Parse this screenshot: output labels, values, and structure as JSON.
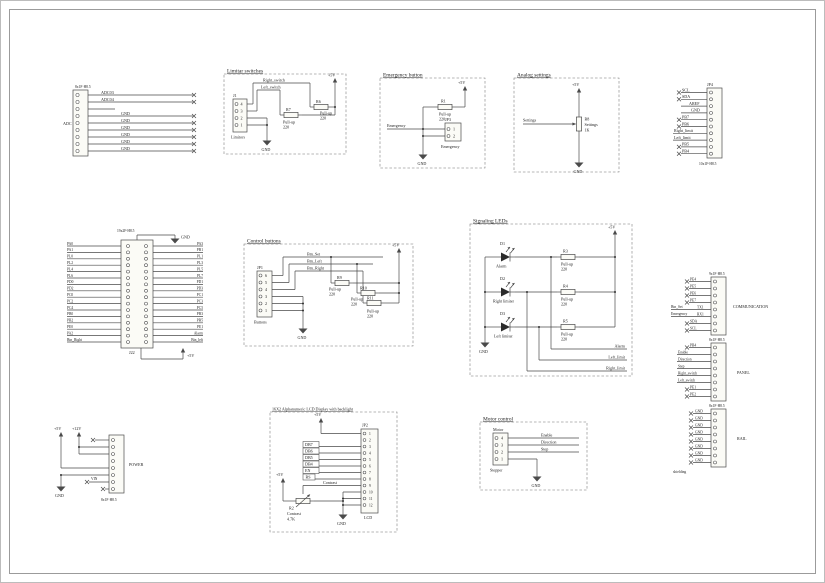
{
  "common": {
    "p5": "+5V",
    "p12": "+12V",
    "gnd": "GND",
    "pullup": "Pull-up",
    "r220": "220"
  },
  "adc": {
    "part": "8x1F-H8.5",
    "group": "ADC",
    "nets": [
      "ADC03",
      "ADC04",
      "",
      "GND",
      "GND",
      "GND",
      "GND",
      "GND",
      "GND"
    ]
  },
  "limits": {
    "title": "Limitar switches",
    "net_right": "Right_switch",
    "net_left": "Left_switch",
    "conn_ref": "J1",
    "conn_name": "Limitors",
    "pins": [
      "4",
      "3",
      "2",
      "1"
    ],
    "r7": "R7",
    "r6": "R6"
  },
  "emergency": {
    "title": "Emergency button",
    "r1": "R1",
    "net": "Emergency",
    "conn_ref": "JP3",
    "pins": [
      "1",
      "2"
    ],
    "conn_name": "Emergency"
  },
  "analog": {
    "title": "Analog settings",
    "net": "Settings",
    "pot_ref": "R8",
    "pot_l1": "Settings",
    "pot_l2": "1K"
  },
  "jp4": {
    "ref": "JP4",
    "part": "10x1F-H8.5",
    "nets": [
      "SCL",
      "SDA",
      "AREF",
      "GND",
      "PB7",
      "PB6",
      "Right_limit",
      "Left_limit",
      "PB5",
      "PB4"
    ]
  },
  "main": {
    "part": "19x2F-H8.5",
    "ref": "J22",
    "left": [
      "PA0",
      "PA1",
      "PL0",
      "PL2",
      "PL4",
      "PL6",
      "PD0",
      "PD2",
      "PC0",
      "PC2",
      "PC4",
      "PB0",
      "PB2",
      "PE0",
      "PA2",
      "Btn_Right"
    ],
    "right": [
      "PA3",
      "PB1",
      "PL1",
      "PL3",
      "PL5",
      "PL7",
      "PD1",
      "PD3",
      "PC1",
      "PC3",
      "PC5",
      "PB3",
      "PB5",
      "PE1",
      "Alarm",
      "Btn_left"
    ]
  },
  "buttons": {
    "title": "Control buttons",
    "nets": [
      "Btn_Set",
      "Btn_Left",
      "Btn_Right"
    ],
    "conn_ref": "JP1",
    "conn_name": "Buttons",
    "pins": [
      "6",
      "5",
      "4",
      "3",
      "2",
      "1"
    ],
    "r": [
      "R9",
      "R10",
      "R11"
    ]
  },
  "leds": {
    "title": "Signaling LEDs",
    "d": [
      {
        "ref": "D1",
        "name": "Alarm"
      },
      {
        "ref": "D2",
        "name": "Right limiter"
      },
      {
        "ref": "D3",
        "name": "Left limiter"
      }
    ],
    "r": [
      "R3",
      "R4",
      "R5"
    ],
    "out": [
      "Alarm",
      "Left_limit",
      "Right_limit"
    ]
  },
  "io": {
    "part1": "9x1F-H8.5",
    "nets1": [
      "PE4",
      "PE5",
      "PE6",
      "PE7",
      "TX1",
      "RX1",
      "SDA",
      "SCL"
    ],
    "ext1": "Btn_Set",
    "ext2": "Emergency",
    "group1": "COMMUNICATION",
    "part2": "8x1F-H8.5",
    "nets2": [
      "PB4",
      "Enable",
      "Direction",
      "Step",
      "Right_switch",
      "Left_switch",
      "PE1",
      "PE2"
    ],
    "group2": "PANEL",
    "part3": "8x1F-H8.5",
    "nets3": [
      "GND",
      "GND",
      "GND",
      "GND",
      "GND",
      "GND",
      "GND",
      "GND"
    ],
    "group3": "RAIL",
    "note": "shielding"
  },
  "lcd": {
    "title": "16X2 Alphanumeric LCD Display with backlight",
    "conn_ref": "JP2",
    "conn_name": "LCD",
    "pins": [
      "1",
      "2",
      "3",
      "4",
      "5",
      "6",
      "7",
      "8",
      "9",
      "10",
      "11",
      "12"
    ],
    "nets": [
      "DB7",
      "DB6",
      "DB5",
      "DB4",
      "EN"
    ],
    "rs": "RS",
    "contrast": "Contrast",
    "pot_ref": "R2",
    "pot_l1": "Contrast",
    "pot_l2": "4.7K"
  },
  "motor": {
    "title": "Motor control",
    "conn_ref": "Motor",
    "conn_name": "Stepper",
    "pins": [
      "4",
      "3",
      "2",
      "1"
    ],
    "nets": [
      "Enable",
      "Direction",
      "Step"
    ]
  },
  "power": {
    "part": "8x1F-H8.5",
    "group": "POWER",
    "vin": "VIN"
  }
}
